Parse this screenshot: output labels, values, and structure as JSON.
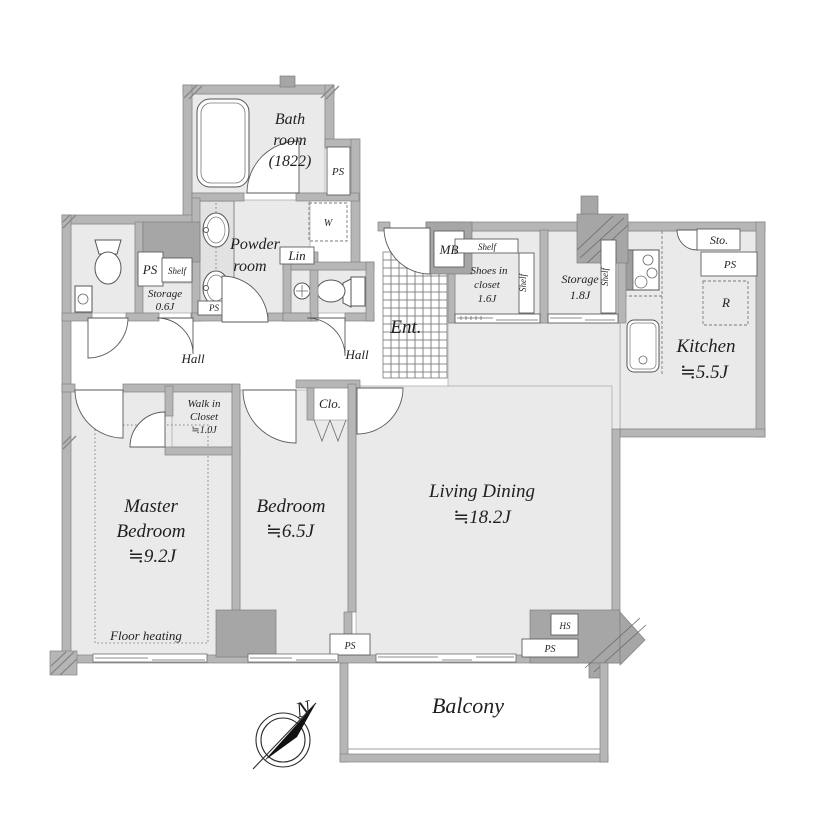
{
  "plan_title": "apartment-floor-plan",
  "colors": {
    "wall": "#b6b6b6",
    "wall_dark": "#a6a6a6",
    "room_floor": "#eaeaea",
    "background": "#ffffff",
    "text": "#1f1f1f"
  },
  "rooms": {
    "bath": {
      "line1": "Bath",
      "line2": "room",
      "line3": "(1822)"
    },
    "powder": {
      "line1": "Powder",
      "line2": "room"
    },
    "storage_small": {
      "line1": "Storage",
      "line2": "0.6J"
    },
    "shoes_closet": {
      "line1": "Shoes in",
      "line2": "closet",
      "line3": "1.6J"
    },
    "storage_big": {
      "line1": "Storage",
      "line2": "1.8J"
    },
    "kitchen": {
      "name": "Kitchen",
      "size": "≒5.5J"
    },
    "entrance": {
      "name": "Ent."
    },
    "hall": "Hall",
    "walk_in_closet": {
      "line1": "Walk in",
      "line2": "Closet",
      "line3": "≒1.0J"
    },
    "closet": "Clo.",
    "master_bedroom": {
      "line1": "Master",
      "line2": "Bedroom",
      "size": "≒9.2J"
    },
    "bedroom": {
      "name": "Bedroom",
      "size": "≒6.5J"
    },
    "living_dining": {
      "name": "Living Dining",
      "size": "≒18.2J"
    },
    "balcony": "Balcony",
    "floor_heating": "Floor heating"
  },
  "labels": {
    "ps": "PS",
    "shelf": "Shelf",
    "w": "W",
    "lin": "Lin",
    "mb": "MB",
    "sto": "Sto.",
    "r": "R",
    "hs": "HS",
    "north": "N"
  }
}
